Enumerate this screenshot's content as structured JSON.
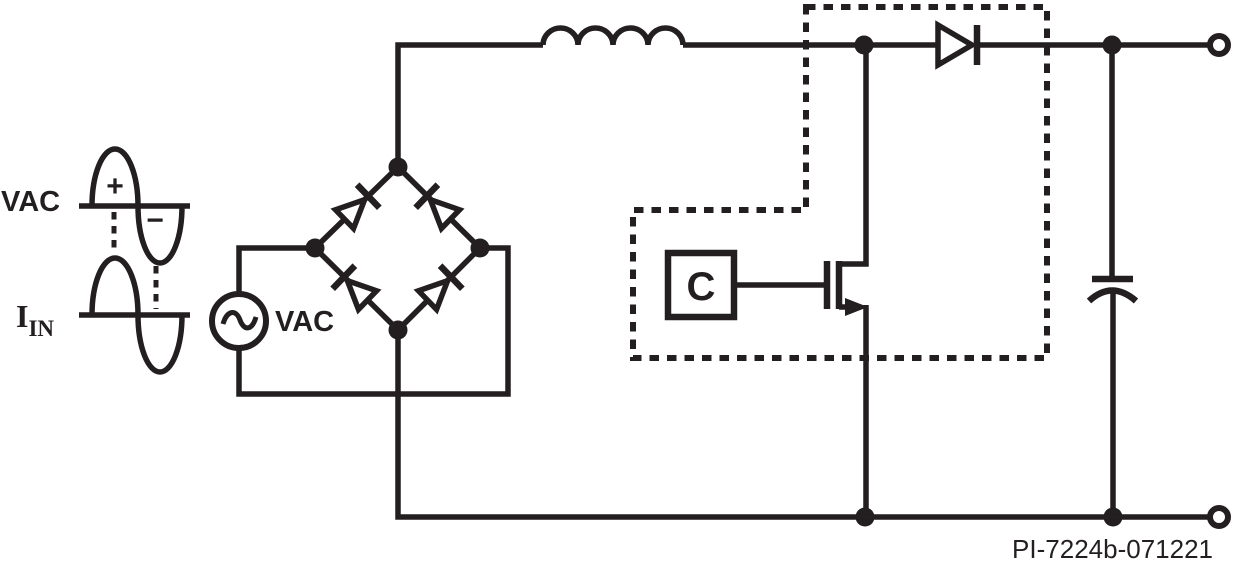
{
  "waveforms": {
    "vac_label": "VAC",
    "plus_sign": "+",
    "minus_sign": "−",
    "iin_label_base": "I",
    "iin_label_sub": "IN"
  },
  "circuit": {
    "ac_source_label": "VAC",
    "controller_label": "C"
  },
  "figure": {
    "part_number": "PI-7224b-071221"
  },
  "colors": {
    "ink": "#231f20",
    "background": "#ffffff"
  },
  "components": [
    "vac-waveform",
    "iin-waveform",
    "ac-source",
    "bridge-rectifier",
    "boost-inductor",
    "ic-boundary",
    "controller",
    "power-mosfet",
    "boost-diode",
    "output-capacitor",
    "output-terminal-positive",
    "output-terminal-negative"
  ]
}
